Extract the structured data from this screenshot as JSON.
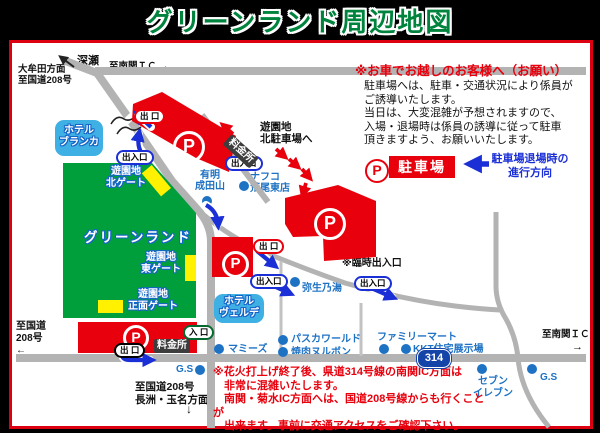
{
  "title": "グリーンランド周辺地図",
  "colors": {
    "accent_red": "#e8000d",
    "park_green": "#009f3c",
    "gate_yellow": "#fff100",
    "hotel_blue": "#3fb0e4",
    "poi_blue": "#1e72c4",
    "arrow_blue": "#1b2fd6",
    "road_gray": "#b3b3b3",
    "toll_dark": "#3d3d3d"
  },
  "roads": {
    "fukase": "深瀬",
    "to_nankan_top": "至南関ＩＣ →",
    "omuta": "大牟田方面\n至国道208号",
    "route208_left": "至国道\n208号\n←",
    "route208_bottom": "至国道208号\n長洲・玉名方面",
    "route208_bottom_arrow": "↓",
    "to_nankan_right": "至南関ＩＣ",
    "to_nankan_right_arrow": "→",
    "route314": "314"
  },
  "park": {
    "name": "グリーンランド",
    "north_gate": "遊園地\n北ゲート",
    "east_gate": "遊園地\n東ゲート",
    "front_gate": "遊園地\n正面ゲート"
  },
  "hotels": {
    "blanca": "ホテル\nブランカ",
    "verde": "ホテル\nヴェルデ"
  },
  "pois": [
    {
      "name": "有明\n成田山"
    },
    {
      "name": "ナフコ\n荒尾東店"
    },
    {
      "name": "弥生乃湯"
    },
    {
      "name": "マミーズ"
    },
    {
      "name": "パスカワールド"
    },
    {
      "name": "焼肉ヌルボン"
    },
    {
      "name": "ファミリーマート"
    },
    {
      "name": "KKT住宅展示場"
    },
    {
      "name": "セブン\nイレブン"
    },
    {
      "name": "G.S"
    },
    {
      "name": "G.S"
    }
  ],
  "markers": {
    "p": "P",
    "exit": "出 口",
    "entrance": "入 口",
    "in_out": "出入口",
    "temp_in_out": "※臨時出入口",
    "toll": "料金所",
    "north_lot_note": "遊園地\n北駐車場へ"
  },
  "notice": {
    "title": "※お車でお越しのお客様へ（お願い）",
    "body": "駐車場へは、駐車・交通状況により係員が\nご誘導いたします。\n当日は、大変混雑が予想されますので、\n入場・退場時は係員の誘導に従って駐車\n頂きますよう、お願いいたします。"
  },
  "legend": {
    "parking": "駐車場",
    "direction": "駐車場退場時の\n進行方向"
  },
  "road_note": "※花火打上げ終了後、県道314号線の南関IC方面は\n　非常に混雑いたします。\n　南関・菊水IC方面へは、国道208号線からも行くことが\n　出来ます。事前に交通アクセスをご確認下さい。"
}
